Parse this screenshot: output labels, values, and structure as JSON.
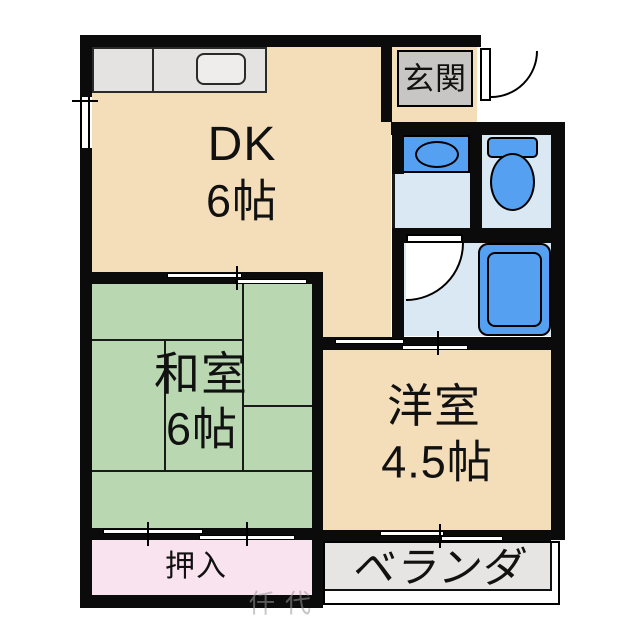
{
  "plan_title": "apartment-floor-plan",
  "rooms": {
    "dk": {
      "name": "DK",
      "size": "6帖"
    },
    "washitsu": {
      "name": "和室",
      "size": "6帖"
    },
    "yoshitsu": {
      "name": "洋室",
      "size": "4.5帖"
    },
    "genkan": {
      "name": "玄関"
    },
    "oshiire": {
      "name": "押入"
    },
    "veranda": {
      "name": "ベランダ"
    }
  },
  "fixtures": [
    "kitchen-counter",
    "kitchen-sink",
    "washbasin",
    "toilet",
    "bathtub"
  ],
  "watermark": "仟代",
  "colors": {
    "wall": "#0b0b0b",
    "room_beige": "#f4deba",
    "tatami_green": "#b9d8b1",
    "closet_pink": "#f8e3ef",
    "fixture_blue": "#55a0f0",
    "wet_floor_blue": "#dae8f4",
    "counter_gray": "#e5e3e1",
    "genkan_gray": "#c7c6c5",
    "veranda_gray": "#e7e5e3"
  }
}
